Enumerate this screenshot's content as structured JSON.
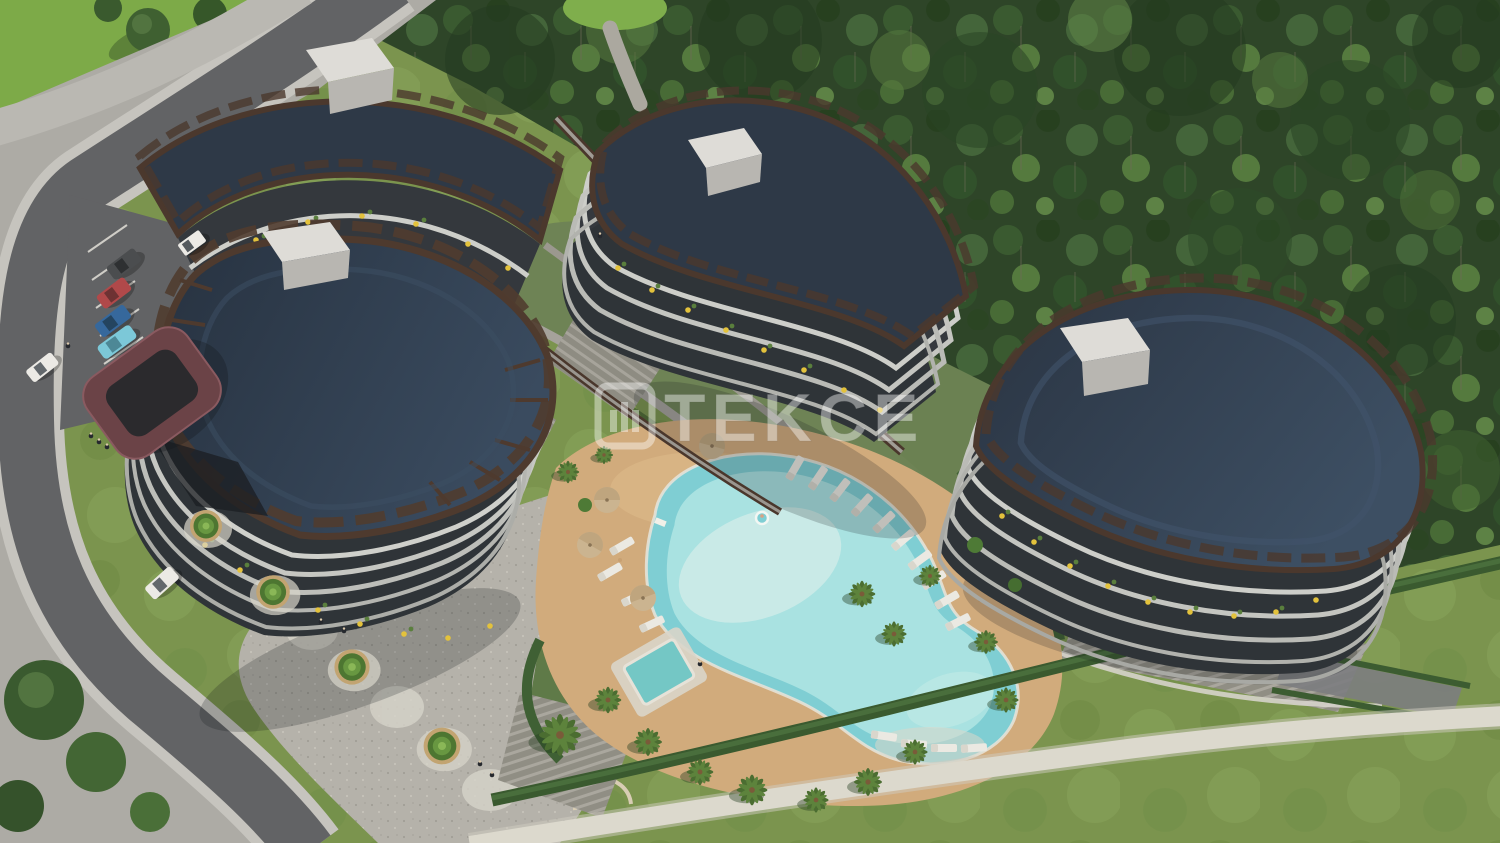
{
  "watermark": {
    "brand": "TEKCE",
    "logo": "tekce-square-bars-logo",
    "color": "#ffffff",
    "opacity": 0.42
  },
  "scene": {
    "setting": "Aerial 3D architectural rendering of a curved residential complex beside a dense pine forest",
    "elements": [
      "four wavy-roofed apartment blocks with navy roofs and brown pergola trim",
      "free-form turquoise swimming pool with lighter shallow island",
      "square kids pool / jacuzzi",
      "white sun loungers and tan parasols",
      "palm trees around the pool deck",
      "terraced landscaped gardens with elevated brown walkways",
      "pedestrian promenade with conifer planters and round paving medallions",
      "asphalt access road with light curbs",
      "parked cars (white van, gray, red, blue, cyan) and two white cars driving",
      "dark red entrance canopy",
      "pine forest backdrop",
      "lawn with sand path and trimmed hedge"
    ]
  },
  "palette": {
    "roof_navy": "#2e3947",
    "roof_trim_brown": "#4b382d",
    "facade_light": "#cfd0cb",
    "facade_dark": "#35393e",
    "planter_yellow": "#e3c23c",
    "pool_outer": "#7fced3",
    "pool_mid": "#a9e2e1",
    "pool_inner": "#ccebe8",
    "jacuzzi": "#74c7c5",
    "deck_tan": "#d1ab7c",
    "road_dark": "#626365",
    "curb_light": "#c6c4be",
    "pavement_light": "#adaba5",
    "grass_bright": "#7daa48",
    "lawn_green": "#7b944e",
    "lawn_path": "#dcd9cd",
    "forest_dark": "#2e4528",
    "hedge_green": "#3a5a2f",
    "canopy_maroon": "#6b4347",
    "white_structure": "#dedcd7",
    "car_red": "#b0494a",
    "car_blue": "#36689c",
    "car_cyan": "#7cc8d8",
    "car_white": "#eceae5",
    "car_gray": "#4b4d4f",
    "palm_green": "#4b6d31",
    "umbrella_tan": "#cbb490"
  }
}
